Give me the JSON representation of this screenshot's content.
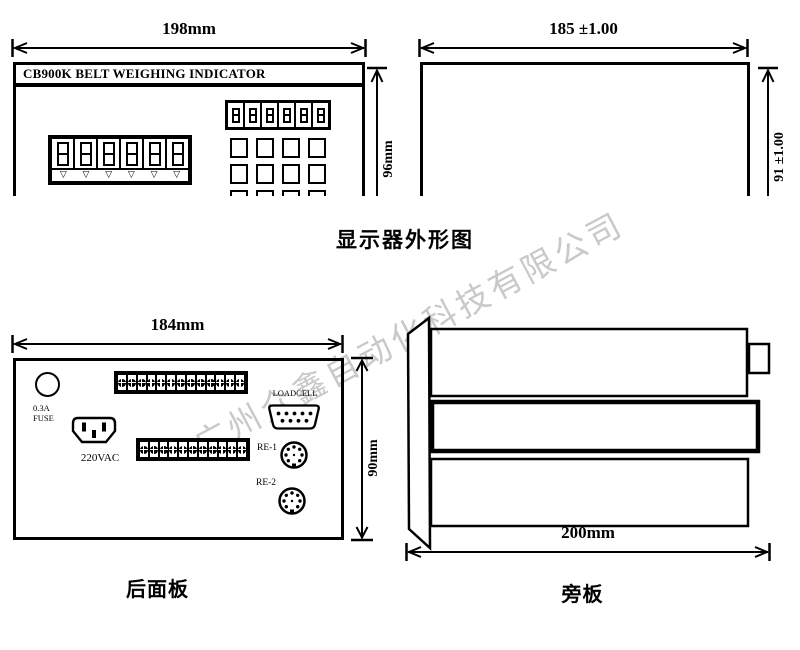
{
  "watermark": {
    "text": "广州众鑫自动化科技有限公司",
    "color": "#c9c9c9"
  },
  "front_view": {
    "width_dim": "198mm",
    "height_dim": "96mm",
    "header": "CB900K BELT WEIGHING INDICATOR",
    "display_digits": 6,
    "small_display_digits": 6,
    "indicator_triangle": "▽",
    "keypad": {
      "rows": 3,
      "cols": 4
    }
  },
  "outline_view": {
    "width_dim": "185 ±1.00",
    "height_dim": "91 ±1.00"
  },
  "top_caption": "显示器外形图",
  "rear_view": {
    "width_dim": "184mm",
    "height_dim": "90mm",
    "fuse_label_line1": "0.3A",
    "fuse_label_line2": "FUSE",
    "power_label": "220VAC",
    "loadcell_label": "LOADCELL",
    "re1_label": "RE-1",
    "re2_label": "RE-2",
    "top_terminal_count": 13,
    "bottom_terminal_count": 11
  },
  "rear_caption": "后面板",
  "side_view": {
    "width_dim": "200mm"
  },
  "side_caption": "旁板"
}
